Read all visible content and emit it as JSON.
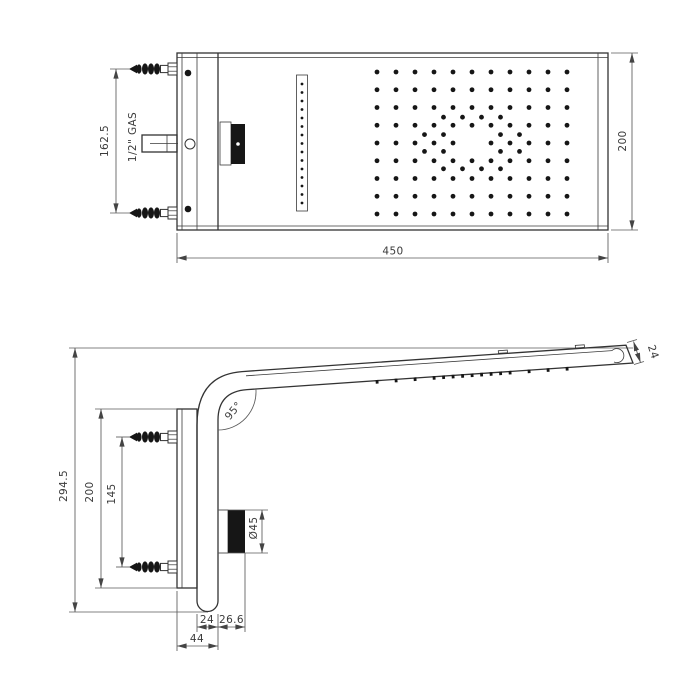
{
  "top_view": {
    "width": "450",
    "depth": "200",
    "connector_spacing": "162.5",
    "inlet_thread": "1/2\" GAS",
    "spray_grid": {
      "cols": 11,
      "rows": 9
    },
    "slot_holes": 15
  },
  "side_view": {
    "overall_height": "294.5",
    "plate_height": "200",
    "connector_spacing": "145",
    "bend_angle": "95°",
    "knob_diameter": "Ø45",
    "body_depth": "24",
    "knob_protrusion": "26.6",
    "total_depth": "44",
    "arm_end_thickness": "24"
  }
}
